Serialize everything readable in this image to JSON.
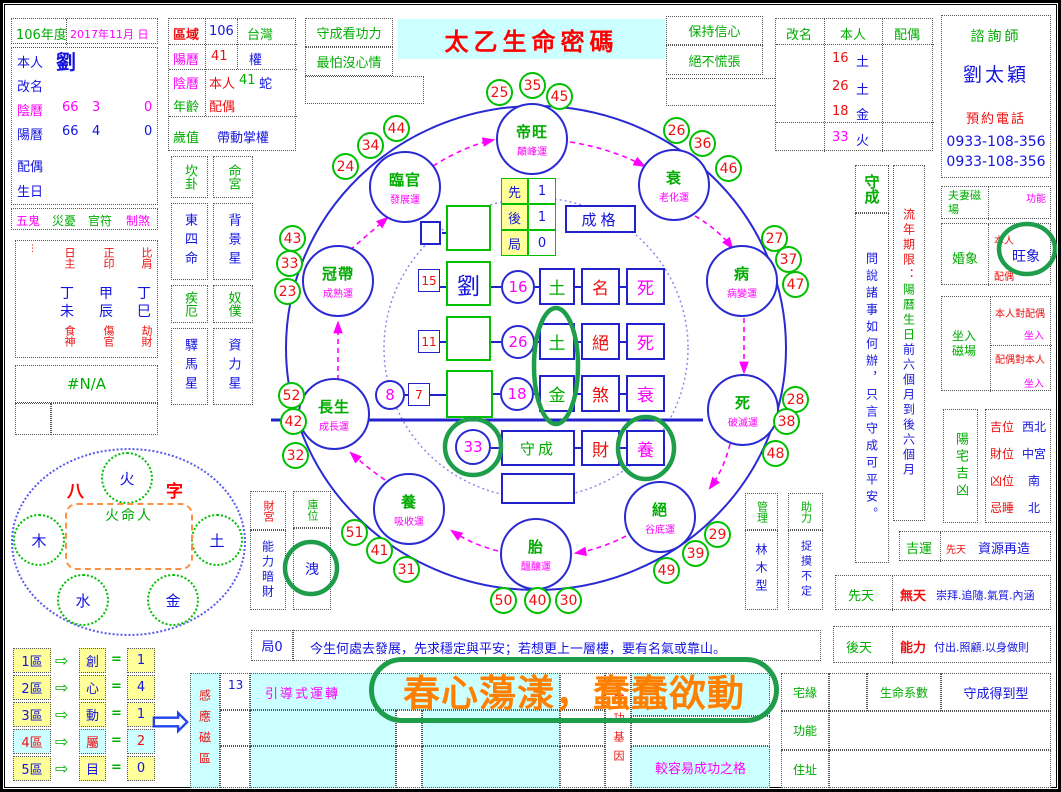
{
  "title": "太乙生命密碼",
  "profile": {
    "year": "106年度",
    "date": "2017年11月 日",
    "self_label": "本人",
    "self_value": "劉",
    "rename_label": "改名",
    "lunar_label": "陰曆",
    "lunar_v1": "66",
    "lunar_v2": "3",
    "lunar_v3": "0",
    "solar_label": "陽曆",
    "solar_v1": "66",
    "solar_v2": "4",
    "solar_v3": "0",
    "spouse_label": "配偶",
    "birthday_label": "生日",
    "curses": [
      "五鬼",
      "災憂",
      "官符",
      "制煞"
    ],
    "bazi": {
      "marks": "⋮",
      "headers": [
        "日主",
        "正印",
        "比肩"
      ],
      "stems": [
        "丁",
        "甲",
        "丁"
      ],
      "branches": [
        "未",
        "辰",
        "巳"
      ],
      "gods": [
        "食神",
        "傷官",
        "劫財"
      ]
    },
    "na": "#N/A"
  },
  "region": {
    "r1": {
      "label": "區域",
      "v1": "106",
      "v2": "台灣"
    },
    "r2": {
      "label": "陽曆",
      "v1": "41",
      "v2": "權"
    },
    "r3a": {
      "label": "陰曆",
      "p1": "本人",
      "p2": "41",
      "p3": "蛇"
    },
    "r3b": {
      "label": "年齡",
      "p1": "配偶"
    },
    "r4": {
      "label": "歲值",
      "v": "帶動掌權"
    }
  },
  "palaces": {
    "h1": "坎卦",
    "h2": "命宮",
    "v1": "東四命",
    "v2": "背景星",
    "h3": "疾厄",
    "h4": "奴僕",
    "v3": "驛馬星",
    "v4": "資力星"
  },
  "mottos": {
    "l1": "守成看功力",
    "l2": "最怕沒心情",
    "r1": "保持信心",
    "r2": "絕不慌張"
  },
  "rename_grid": {
    "headers": [
      "改名",
      "本人",
      "配偶"
    ],
    "rows": [
      {
        "num": "16",
        "el": "土"
      },
      {
        "num": "26",
        "el": "土"
      },
      {
        "num": "18",
        "el": "金"
      }
    ],
    "final": {
      "num": "33",
      "el": "火"
    }
  },
  "consultant": {
    "title": "諮詢師",
    "name": "劉太穎",
    "phone_label": "預約電話",
    "phone1": "0933-108-356",
    "phone2": "0933-108-356"
  },
  "shoucheng": {
    "title": "守成",
    "body": "問說諸事如何辦，只言守成可平安。"
  },
  "liunian": {
    "s1": "流年期限：",
    "s2": "陽曆生日",
    "s3": "前六個月到後六個月"
  },
  "couple": {
    "label": "夫妻磁場",
    "tag": "功能"
  },
  "marriage": {
    "label": "婚象",
    "p1": "本人",
    "value": "旺象",
    "p2": "配偶"
  },
  "sitting": {
    "label": "坐入磁場",
    "r1": "本人對配偶",
    "r1tag": "坐入",
    "r2": "配偶對本人",
    "r2tag": "坐入"
  },
  "house": {
    "label": "陽宅吉凶",
    "rows": [
      {
        "k": "吉位",
        "v": "西北"
      },
      {
        "k": "財位",
        "v": "中宮"
      },
      {
        "k": "凶位",
        "v": "南"
      },
      {
        "k": "忌睡",
        "v": "北"
      }
    ]
  },
  "luck": {
    "label": "吉運",
    "tag": "先天",
    "value": "資源再造"
  },
  "innate": {
    "label": "先天",
    "tag": "無天",
    "value": "崇拜.追隨.氣質.內涵"
  },
  "acquired": {
    "label": "後天",
    "tag": "能力",
    "value": "付出.照顧.以身做則"
  },
  "manage": {
    "label": "管理",
    "value": "林木型"
  },
  "assist": {
    "label": "助力",
    "value": "捉摸不定"
  },
  "treasury": {
    "c1h": "財宮",
    "c1b": "能力暗財",
    "c2h": "庫位",
    "c2b": "洩"
  },
  "bazi_wheel": {
    "t1": "八",
    "t2": "字",
    "center": "火命人",
    "top": "火",
    "left": "木",
    "right": "土",
    "bottom_left": "水",
    "bottom_right": "金"
  },
  "zones": {
    "arrow": "⇨",
    "eq": "=",
    "big_arrow": "⇨",
    "rows": [
      {
        "label": "1區",
        "char": "創",
        "value": "1",
        "hl": false
      },
      {
        "label": "2區",
        "char": "心",
        "value": "4",
        "hl": false
      },
      {
        "label": "3區",
        "char": "動",
        "value": "1",
        "hl": false
      },
      {
        "label": "4區",
        "char": "屬",
        "value": "2",
        "hl": true
      },
      {
        "label": "5區",
        "char": "目",
        "value": "0",
        "hl": false
      }
    ]
  },
  "ju": {
    "label": "局0",
    "text": "今生何處去發展，先求穩定與平安；若想更上一層樓，要有名氣或靠山。"
  },
  "induction": {
    "header": "感應磁區",
    "num": "13",
    "row1": "引導式運轉",
    "overlay": "春心蕩漾，蠢蠢欲動",
    "right_header": "成功基因",
    "bottom": "較容易成功之格"
  },
  "home": {
    "r1a": "宅緣",
    "r1b": "生命系數",
    "r1c": "守成得到型",
    "r2": "功能",
    "r3": "住址"
  },
  "center": {
    "mini": [
      {
        "k": "先",
        "v": "1"
      },
      {
        "k": "後",
        "v": "1"
      },
      {
        "k": "局",
        "v": "0"
      }
    ],
    "grade": "成格",
    "r1": {
      "num": "15",
      "name": "劉",
      "circle": "16",
      "c1": "土",
      "c2": "名",
      "c3": "死"
    },
    "r2": {
      "num": "11",
      "circle": "26",
      "c1": "土",
      "c2": "絕",
      "c3": "死"
    },
    "r3": {
      "pre": "8",
      "num": "7",
      "circle": "18",
      "c1": "金",
      "c2": "煞",
      "c3": "衰"
    },
    "r4": {
      "circle": "33",
      "name": "守成",
      "c2": "財",
      "c3": "養"
    }
  },
  "cycle": {
    "stages": [
      {
        "name": "帝旺",
        "sub": "顛峰運",
        "cx": 529,
        "cy": 136
      },
      {
        "name": "衰",
        "sub": "老化運",
        "cx": 671,
        "cy": 182
      },
      {
        "name": "病",
        "sub": "病變運",
        "cx": 739,
        "cy": 278
      },
      {
        "name": "死",
        "sub": "破滅運",
        "cx": 740,
        "cy": 407
      },
      {
        "name": "絕",
        "sub": "谷底運",
        "cx": 657,
        "cy": 514
      },
      {
        "name": "胎",
        "sub": "醞釀運",
        "cx": 533,
        "cy": 551
      },
      {
        "name": "養",
        "sub": "吸收運",
        "cx": 406,
        "cy": 506
      },
      {
        "name": "長生",
        "sub": "成長運",
        "cx": 331,
        "cy": 411
      },
      {
        "name": "冠帶",
        "sub": "成熟運",
        "cx": 335,
        "cy": 278
      },
      {
        "name": "臨官",
        "sub": "發展運",
        "cx": 402,
        "cy": 184
      }
    ],
    "numbers": [
      {
        "v": "25",
        "x": 497,
        "y": 90
      },
      {
        "v": "35",
        "x": 530,
        "y": 83
      },
      {
        "v": "45",
        "x": 557,
        "y": 94
      },
      {
        "v": "26",
        "x": 674,
        "y": 128
      },
      {
        "v": "36",
        "x": 700,
        "y": 141
      },
      {
        "v": "46",
        "x": 726,
        "y": 166
      },
      {
        "v": "27",
        "x": 772,
        "y": 236
      },
      {
        "v": "37",
        "x": 786,
        "y": 257
      },
      {
        "v": "47",
        "x": 793,
        "y": 282
      },
      {
        "v": "28",
        "x": 793,
        "y": 397
      },
      {
        "v": "38",
        "x": 784,
        "y": 419
      },
      {
        "v": "48",
        "x": 773,
        "y": 451
      },
      {
        "v": "29",
        "x": 715,
        "y": 532
      },
      {
        "v": "39",
        "x": 693,
        "y": 551
      },
      {
        "v": "49",
        "x": 664,
        "y": 568
      },
      {
        "v": "50",
        "x": 501,
        "y": 598
      },
      {
        "v": "40",
        "x": 535,
        "y": 598
      },
      {
        "v": "30",
        "x": 566,
        "y": 598
      },
      {
        "v": "31",
        "x": 404,
        "y": 567
      },
      {
        "v": "41",
        "x": 377,
        "y": 548
      },
      {
        "v": "51",
        "x": 352,
        "y": 530
      },
      {
        "v": "32",
        "x": 293,
        "y": 453
      },
      {
        "v": "42",
        "x": 291,
        "y": 419
      },
      {
        "v": "52",
        "x": 289,
        "y": 393
      },
      {
        "v": "23",
        "x": 285,
        "y": 289
      },
      {
        "v": "33",
        "x": 287,
        "y": 261
      },
      {
        "v": "43",
        "x": 290,
        "y": 236
      },
      {
        "v": "24",
        "x": 343,
        "y": 164
      },
      {
        "v": "34",
        "x": 368,
        "y": 143
      },
      {
        "v": "44",
        "x": 394,
        "y": 126
      }
    ]
  },
  "colors": {
    "green": "#00ac00",
    "blue": "#1414e0",
    "red": "#ee1010",
    "magenta": "#ff00ff",
    "orange": "#ff7f00",
    "annotation": "#1e9e4b",
    "cyan_bg": "#ccffff",
    "yellow_bg": "#ffff99"
  }
}
